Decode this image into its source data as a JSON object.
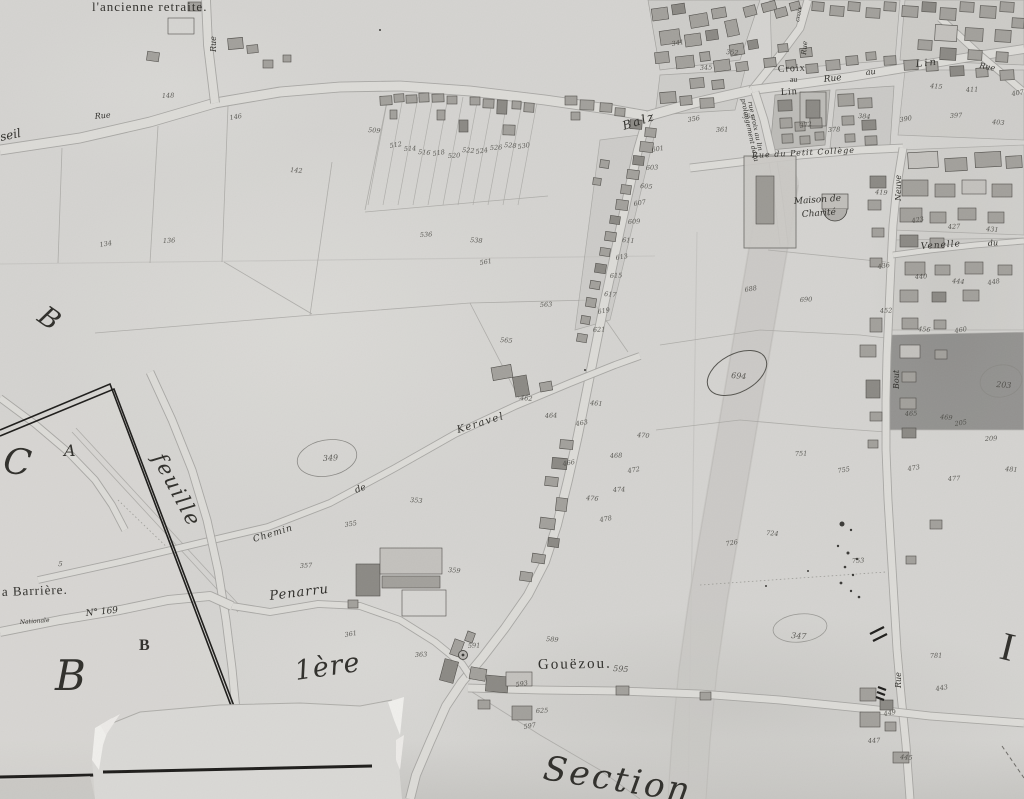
{
  "map_title": "Section",
  "colors": {
    "paper": "#d4d3d0",
    "ink": "#2f2e2a",
    "number_ink": "#45443f",
    "building": "#a2a09b",
    "building_dark": "#8b8984",
    "building_light": "#c3c1bd",
    "road_fill": "#dcdbd7",
    "road_edge": "#a3a29e",
    "wide_band": "#c8c7c3",
    "frame_ink": "#1d1c1a",
    "torn_paper": "#f0efec"
  },
  "labels": [
    {
      "id": "ancienne-retraite",
      "text": "l'ancienne retraite.",
      "x": 92,
      "y": 11,
      "size": 13,
      "rot": 0,
      "font": "print",
      "ls": 1
    },
    {
      "id": "rue-north",
      "text": "Rue",
      "x": 216,
      "y": 52,
      "size": 8,
      "rot": -90,
      "font": "script",
      "ls": 0
    },
    {
      "id": "rue-west",
      "text": "Rue",
      "x": 95,
      "y": 119,
      "size": 8,
      "rot": -6,
      "font": "script",
      "ls": 0
    },
    {
      "id": "partial-seil",
      "text": "seil",
      "x": 1,
      "y": 141,
      "size": 12,
      "rot": -12,
      "font": "script",
      "ls": 0
    },
    {
      "id": "rue-balz",
      "text": "Balz",
      "x": 624,
      "y": 130,
      "size": 12,
      "rot": -18,
      "font": "script",
      "ls": 2
    },
    {
      "id": "croix-au-lin-1",
      "text": "Croix",
      "x": 778,
      "y": 72,
      "size": 10,
      "rot": -3,
      "font": "print",
      "ls": 1
    },
    {
      "id": "croix-au-lin-2",
      "text": "au",
      "x": 790,
      "y": 82,
      "size": 8,
      "rot": -3,
      "font": "print",
      "ls": 0
    },
    {
      "id": "croix-au-lin-3",
      "text": "Lin",
      "x": 781,
      "y": 95,
      "size": 10,
      "rot": -3,
      "font": "print",
      "ls": 1
    },
    {
      "id": "rue-au-lin-1",
      "text": "Rue",
      "x": 824,
      "y": 82,
      "size": 9,
      "rot": -6,
      "font": "script",
      "ls": 0
    },
    {
      "id": "rue-au-lin-2",
      "text": "au",
      "x": 866,
      "y": 75,
      "size": 8,
      "rot": -6,
      "font": "script",
      "ls": 0
    },
    {
      "id": "rue-au-lin-3",
      "text": "Lin",
      "x": 916,
      "y": 67,
      "size": 10,
      "rot": -6,
      "font": "script",
      "ls": 2
    },
    {
      "id": "prolongement-1",
      "text": "prolongement de la",
      "x": 741,
      "y": 99,
      "size": 6.5,
      "rot": 78,
      "font": "script",
      "ls": 0
    },
    {
      "id": "prolongement-2",
      "text": "rue croix au lin",
      "x": 748,
      "y": 102,
      "size": 6.5,
      "rot": 78,
      "font": "script",
      "ls": 0
    },
    {
      "id": "rue-croix-vert",
      "text": "Rue",
      "x": 806,
      "y": 55,
      "size": 7,
      "rot": -85,
      "font": "script",
      "ls": 0
    },
    {
      "id": "croix-vert",
      "text": "croix",
      "x": 799,
      "y": 22,
      "size": 6,
      "rot": -80,
      "font": "script",
      "ls": 0
    },
    {
      "id": "rue-ne",
      "text": "Rue",
      "x": 979,
      "y": 68,
      "size": 8,
      "rot": 10,
      "font": "script",
      "ls": 0
    },
    {
      "id": "rue-petit-college",
      "text": "Rue du Petit Collège",
      "x": 752,
      "y": 158,
      "size": 8,
      "rot": -3,
      "font": "script",
      "ls": 1
    },
    {
      "id": "maison-charite-1",
      "text": "Maison de",
      "x": 794,
      "y": 204,
      "size": 9,
      "rot": -4,
      "font": "script",
      "ls": 0
    },
    {
      "id": "maison-charite-2",
      "text": "Charité",
      "x": 802,
      "y": 217,
      "size": 9,
      "rot": -4,
      "font": "script",
      "ls": 0
    },
    {
      "id": "rue-neuve",
      "text": "Neuve",
      "x": 901,
      "y": 201,
      "size": 8,
      "rot": -90,
      "font": "script",
      "ls": 0
    },
    {
      "id": "venelle",
      "text": "Venelle",
      "x": 921,
      "y": 249,
      "size": 9,
      "rot": -4,
      "font": "script",
      "ls": 1
    },
    {
      "id": "venelle-du",
      "text": "du",
      "x": 988,
      "y": 246,
      "size": 8,
      "rot": -4,
      "font": "script",
      "ls": 0
    },
    {
      "id": "rue-bout",
      "text": "Bout",
      "x": 899,
      "y": 389,
      "size": 8,
      "rot": -90,
      "font": "script",
      "ls": 0
    },
    {
      "id": "chemin",
      "text": "Chemin",
      "x": 254,
      "y": 542,
      "size": 9,
      "rot": -17,
      "font": "script",
      "ls": 1
    },
    {
      "id": "chemin-de",
      "text": "de",
      "x": 356,
      "y": 493,
      "size": 9,
      "rot": -20,
      "font": "script",
      "ls": 0
    },
    {
      "id": "keravel",
      "text": "Keravel",
      "x": 458,
      "y": 433,
      "size": 10,
      "rot": -17,
      "font": "script",
      "ls": 1.5
    },
    {
      "id": "feuille",
      "text": "feuille",
      "x": 152,
      "y": 458,
      "size": 21,
      "rot": 62,
      "font": "script",
      "ls": 2
    },
    {
      "id": "letter-c",
      "text": "C",
      "x": 2,
      "y": 472,
      "size": 36,
      "rot": 8,
      "font": "script",
      "ls": 0
    },
    {
      "id": "letter-a",
      "text": "A",
      "x": 64,
      "y": 456,
      "size": 16,
      "rot": 0,
      "font": "script",
      "ls": 0
    },
    {
      "id": "barriere",
      "text": "a Barrière.",
      "x": 2,
      "y": 596,
      "size": 13,
      "rot": -2,
      "font": "print",
      "ls": 1
    },
    {
      "id": "route-script",
      "text": "Nationale",
      "x": 20,
      "y": 624,
      "size": 6,
      "rot": -4,
      "font": "script",
      "ls": 0
    },
    {
      "id": "numero-169",
      "text": "N° 169",
      "x": 86,
      "y": 616,
      "size": 9,
      "rot": -6,
      "font": "script",
      "ls": 0
    },
    {
      "id": "letter-b-small",
      "text": "B",
      "x": 139,
      "y": 650,
      "size": 16,
      "rot": 0,
      "font": "print",
      "bold": true,
      "ls": 0
    },
    {
      "id": "letter-b-large",
      "text": "B",
      "x": 55,
      "y": 690,
      "size": 42,
      "rot": 0,
      "font": "script",
      "ls": 0
    },
    {
      "id": "letter-b-upper",
      "text": "B",
      "x": 36,
      "y": 320,
      "size": 27,
      "rot": 35,
      "font": "script",
      "ls": 0
    },
    {
      "id": "penarru",
      "text": "Penarru",
      "x": 270,
      "y": 600,
      "size": 13,
      "rot": -7,
      "font": "script",
      "ls": 1
    },
    {
      "id": "premiere",
      "text": "1ère",
      "x": 296,
      "y": 680,
      "size": 27,
      "rot": -8,
      "font": "script",
      "ls": 1
    },
    {
      "id": "gouezou",
      "text": "Gouëzou.",
      "x": 538,
      "y": 669,
      "size": 15,
      "rot": -1,
      "font": "print",
      "ls": 2
    },
    {
      "id": "rue-south",
      "text": "Rue",
      "x": 901,
      "y": 688,
      "size": 8,
      "rot": -90,
      "font": "script",
      "ls": 0
    },
    {
      "id": "letter-i",
      "text": "I",
      "x": 998,
      "y": 658,
      "size": 40,
      "rot": 14,
      "font": "print",
      "ls": 0
    },
    {
      "id": "section",
      "text": "Section",
      "x": 542,
      "y": 779,
      "size": 34,
      "rot": 9,
      "font": "script",
      "ls": 3
    }
  ],
  "parcel_numbers": [
    [
      "134",
      100,
      247
    ],
    [
      "136",
      163,
      243
    ],
    [
      "142",
      290,
      172
    ],
    [
      "146",
      230,
      120
    ],
    [
      "148",
      162,
      98
    ],
    [
      "509",
      368,
      132
    ],
    [
      "512",
      390,
      148
    ],
    [
      "514",
      404,
      151
    ],
    [
      "516",
      418,
      154
    ],
    [
      "518",
      433,
      156
    ],
    [
      "520",
      448,
      158
    ],
    [
      "522",
      462,
      152
    ],
    [
      "524",
      476,
      154
    ],
    [
      "526",
      490,
      150
    ],
    [
      "528",
      504,
      147
    ],
    [
      "530",
      518,
      149
    ],
    [
      "536",
      420,
      237
    ],
    [
      "538",
      470,
      242
    ],
    [
      "561",
      480,
      265
    ],
    [
      "563",
      540,
      307
    ],
    [
      "565",
      500,
      342
    ],
    [
      "601",
      652,
      152
    ],
    [
      "603",
      646,
      170
    ],
    [
      "605",
      640,
      188
    ],
    [
      "607",
      634,
      206
    ],
    [
      "609",
      628,
      224
    ],
    [
      "611",
      622,
      242
    ],
    [
      "613",
      616,
      260
    ],
    [
      "615",
      610,
      278
    ],
    [
      "617",
      604,
      296
    ],
    [
      "619",
      598,
      314
    ],
    [
      "621",
      593,
      332
    ],
    [
      "461",
      590,
      405
    ],
    [
      "463",
      576,
      426
    ],
    [
      "464",
      545,
      418
    ],
    [
      "462",
      520,
      400
    ],
    [
      "466",
      563,
      466
    ],
    [
      "468",
      610,
      458
    ],
    [
      "470",
      637,
      437
    ],
    [
      "472",
      628,
      473
    ],
    [
      "474",
      613,
      492
    ],
    [
      "476",
      586,
      500
    ],
    [
      "478",
      600,
      522
    ],
    [
      "349",
      323,
      461,
      0,
      8
    ],
    [
      "353",
      410,
      502
    ],
    [
      "355",
      345,
      527
    ],
    [
      "357",
      300,
      568
    ],
    [
      "359",
      448,
      572
    ],
    [
      "361",
      345,
      637
    ],
    [
      "363",
      415,
      657
    ],
    [
      "595",
      613,
      671,
      0,
      8
    ],
    [
      "593",
      516,
      687
    ],
    [
      "591",
      468,
      648
    ],
    [
      "589",
      546,
      641
    ],
    [
      "597",
      524,
      729
    ],
    [
      "625",
      536,
      713
    ],
    [
      "694",
      731,
      378,
      0,
      8
    ],
    [
      "688",
      745,
      292
    ],
    [
      "690",
      800,
      302
    ],
    [
      "724",
      766,
      535
    ],
    [
      "726",
      726,
      546
    ],
    [
      "753",
      852,
      563
    ],
    [
      "347",
      791,
      638,
      0,
      8
    ],
    [
      "755",
      838,
      473
    ],
    [
      "751",
      795,
      456
    ],
    [
      "203",
      996,
      387,
      0,
      8
    ],
    [
      "205",
      955,
      426
    ],
    [
      "209",
      985,
      441
    ],
    [
      "419",
      875,
      194
    ],
    [
      "423",
      912,
      223
    ],
    [
      "427",
      948,
      229
    ],
    [
      "431",
      986,
      231
    ],
    [
      "436",
      878,
      269
    ],
    [
      "440",
      915,
      279
    ],
    [
      "444",
      952,
      283
    ],
    [
      "448",
      988,
      285
    ],
    [
      "452",
      880,
      313
    ],
    [
      "456",
      918,
      331
    ],
    [
      "460",
      955,
      333
    ],
    [
      "465",
      905,
      416
    ],
    [
      "469",
      940,
      419
    ],
    [
      "473",
      908,
      471
    ],
    [
      "477",
      948,
      481
    ],
    [
      "481",
      1005,
      471
    ],
    [
      "341",
      672,
      46
    ],
    [
      "345",
      700,
      70
    ],
    [
      "352",
      726,
      54
    ],
    [
      "356",
      688,
      122
    ],
    [
      "361",
      716,
      132
    ],
    [
      "364",
      742,
      118
    ],
    [
      "372",
      800,
      128
    ],
    [
      "378",
      828,
      132
    ],
    [
      "384",
      858,
      118
    ],
    [
      "390",
      900,
      122
    ],
    [
      "397",
      950,
      118
    ],
    [
      "403",
      992,
      124
    ],
    [
      "407",
      1012,
      96
    ],
    [
      "411",
      966,
      92
    ],
    [
      "415",
      930,
      88
    ],
    [
      "449",
      884,
      716
    ],
    [
      "447",
      868,
      743
    ],
    [
      "445",
      900,
      759
    ],
    [
      "443",
      936,
      691
    ],
    [
      "781",
      930,
      658
    ],
    [
      "5",
      58,
      566,
      0,
      7
    ]
  ]
}
